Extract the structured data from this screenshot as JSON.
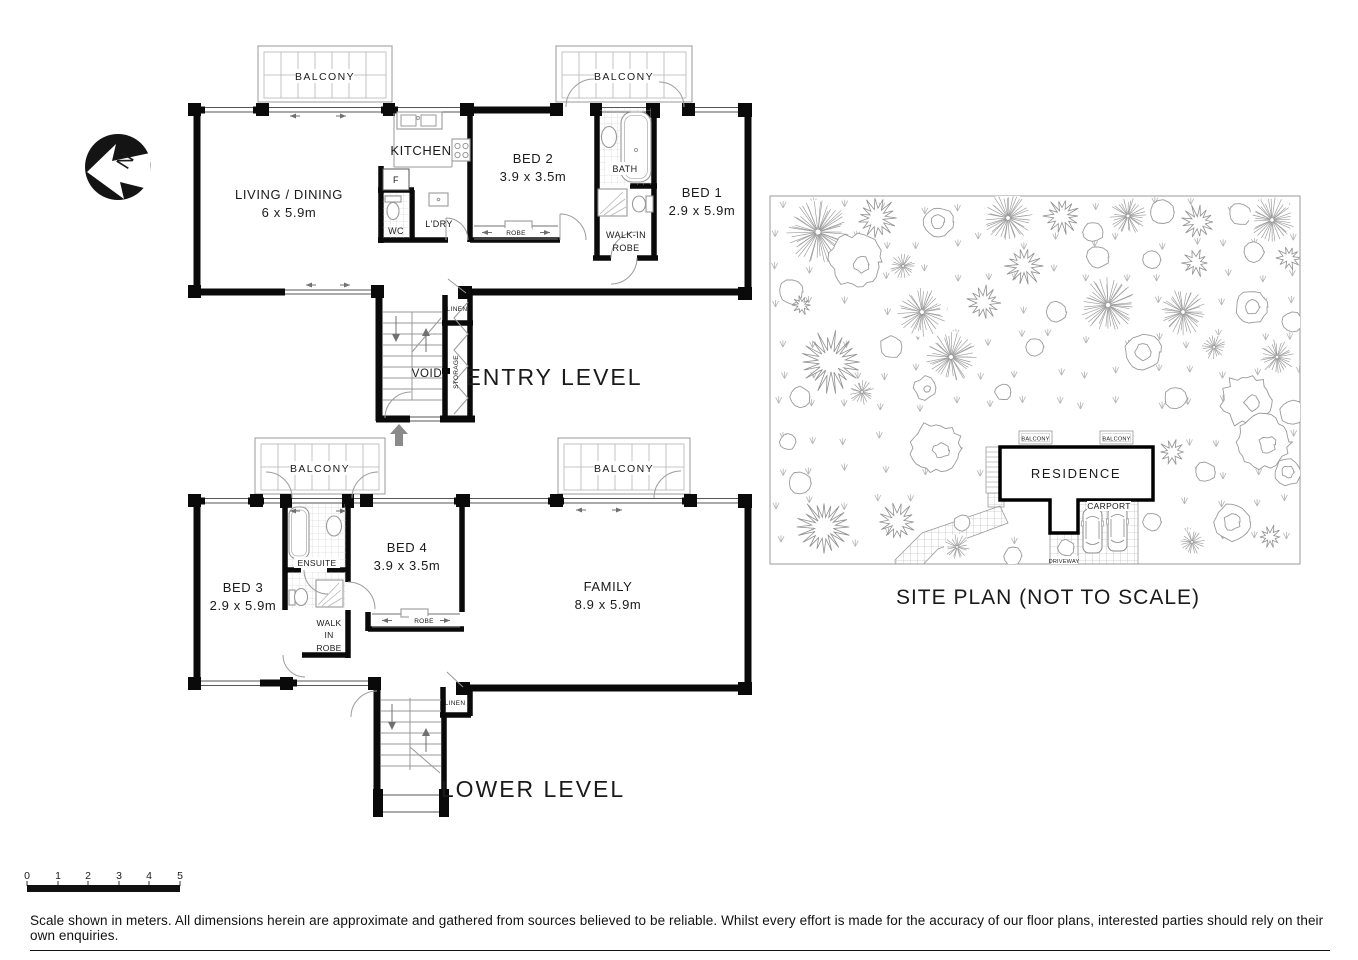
{
  "palette": {
    "ink": "#0a0a0a",
    "line_grey": "#999999",
    "arrow_grey": "#8a8a8a",
    "background": "#ffffff"
  },
  "compass": {
    "label": "N"
  },
  "entry_level": {
    "title": "ENTRY LEVEL",
    "balcony_left": "BALCONY",
    "balcony_right": "BALCONY",
    "living": {
      "name": "LIVING / DINING",
      "dims": "6 x 5.9m"
    },
    "kitchen": "KITCHEN",
    "fridge": "F",
    "wc": "WC",
    "laundry": "L'DRY",
    "bed2": {
      "name": "BED 2",
      "dims": "3.9 x 3.5m"
    },
    "robe": "ROBE",
    "bath": "BATH",
    "walk_in_robe": [
      "WALK-IN",
      "ROBE"
    ],
    "bed1": {
      "name": "BED 1",
      "dims": "2.9 x 5.9m"
    },
    "linen": "LINEN",
    "void": "VOID",
    "storage": "STORAGE"
  },
  "lower_level": {
    "title": "LOWER LEVEL",
    "balcony_left": "BALCONY",
    "balcony_right": "BALCONY",
    "bed3": {
      "name": "BED 3",
      "dims": "2.9 x 5.9m"
    },
    "ensuite": "ENSUITE",
    "walk_in_robe": [
      "WALK",
      "IN",
      "ROBE"
    ],
    "bed4": {
      "name": "BED 4",
      "dims": "3.9 x 3.5m"
    },
    "robe": "ROBE",
    "family": {
      "name": "FAMILY",
      "dims": "8.9 x 5.9m"
    },
    "linen": "LINEN"
  },
  "site_plan": {
    "title": "SITE PLAN (NOT TO SCALE)",
    "residence": "RESIDENCE",
    "carport": "CARPORT",
    "driveway": "DRIVEWAY",
    "balcony_left": "BALCONY",
    "balcony_right": "BALCONY",
    "trees": [
      [
        818,
        232,
        32,
        0
      ],
      [
        877,
        218,
        19,
        1
      ],
      [
        938,
        222,
        15,
        2
      ],
      [
        1008,
        218,
        25,
        0
      ],
      [
        1062,
        216,
        17,
        1
      ],
      [
        1093,
        232,
        10,
        2
      ],
      [
        1128,
        216,
        19,
        0
      ],
      [
        1162,
        212,
        12,
        2
      ],
      [
        1198,
        222,
        16,
        1
      ],
      [
        1240,
        214,
        11,
        2
      ],
      [
        1272,
        220,
        23,
        0
      ],
      [
        791,
        292,
        12,
        2
      ],
      [
        856,
        262,
        26,
        3
      ],
      [
        903,
        266,
        13,
        0
      ],
      [
        1024,
        266,
        18,
        1
      ],
      [
        1098,
        257,
        11,
        2
      ],
      [
        1152,
        260,
        9,
        2
      ],
      [
        1196,
        263,
        13,
        1
      ],
      [
        1254,
        252,
        10,
        2
      ],
      [
        1289,
        258,
        12,
        1
      ],
      [
        802,
        305,
        9,
        1
      ],
      [
        922,
        312,
        25,
        0
      ],
      [
        984,
        303,
        16,
        1
      ],
      [
        1056,
        312,
        10,
        2
      ],
      [
        1108,
        305,
        28,
        0
      ],
      [
        1183,
        312,
        24,
        0
      ],
      [
        1252,
        307,
        16,
        2
      ],
      [
        1292,
        322,
        10,
        2
      ],
      [
        831,
        362,
        28,
        1
      ],
      [
        891,
        347,
        11,
        2
      ],
      [
        951,
        357,
        26,
        0
      ],
      [
        1035,
        347,
        9,
        2
      ],
      [
        1143,
        352,
        18,
        2
      ],
      [
        1214,
        347,
        13,
        0
      ],
      [
        1277,
        357,
        18,
        0
      ],
      [
        800,
        397,
        10,
        2
      ],
      [
        862,
        392,
        13,
        0
      ],
      [
        925,
        388,
        11,
        3
      ],
      [
        1003,
        392,
        8,
        2
      ],
      [
        1176,
        398,
        11,
        2
      ],
      [
        1247,
        400,
        25,
        3
      ],
      [
        1292,
        412,
        12,
        2
      ],
      [
        788,
        442,
        8,
        2
      ],
      [
        936,
        448,
        25,
        3
      ],
      [
        800,
        483,
        11,
        2
      ],
      [
        824,
        527,
        25,
        1
      ],
      [
        897,
        522,
        18,
        1
      ],
      [
        962,
        523,
        8,
        2
      ],
      [
        957,
        547,
        13,
        0
      ],
      [
        1013,
        556,
        9,
        2
      ],
      [
        1172,
        452,
        13,
        1
      ],
      [
        1205,
        472,
        10,
        2
      ],
      [
        1262,
        442,
        27,
        3
      ],
      [
        1288,
        472,
        13,
        2
      ],
      [
        1232,
        522,
        18,
        2
      ],
      [
        1192,
        542,
        13,
        0
      ],
      [
        1270,
        537,
        11,
        1
      ],
      [
        1152,
        522,
        9,
        2
      ],
      [
        1066,
        548,
        8,
        2
      ]
    ]
  },
  "scale_bar": {
    "labels": [
      "0",
      "1",
      "2",
      "3",
      "4",
      "5"
    ]
  },
  "disclaimer": "Scale shown in meters. All dimensions herein are approximate and gathered from sources believed to be  reliable. Whilst every effort is made for the accuracy of our floor plans, interested parties should rely on their own enquiries."
}
